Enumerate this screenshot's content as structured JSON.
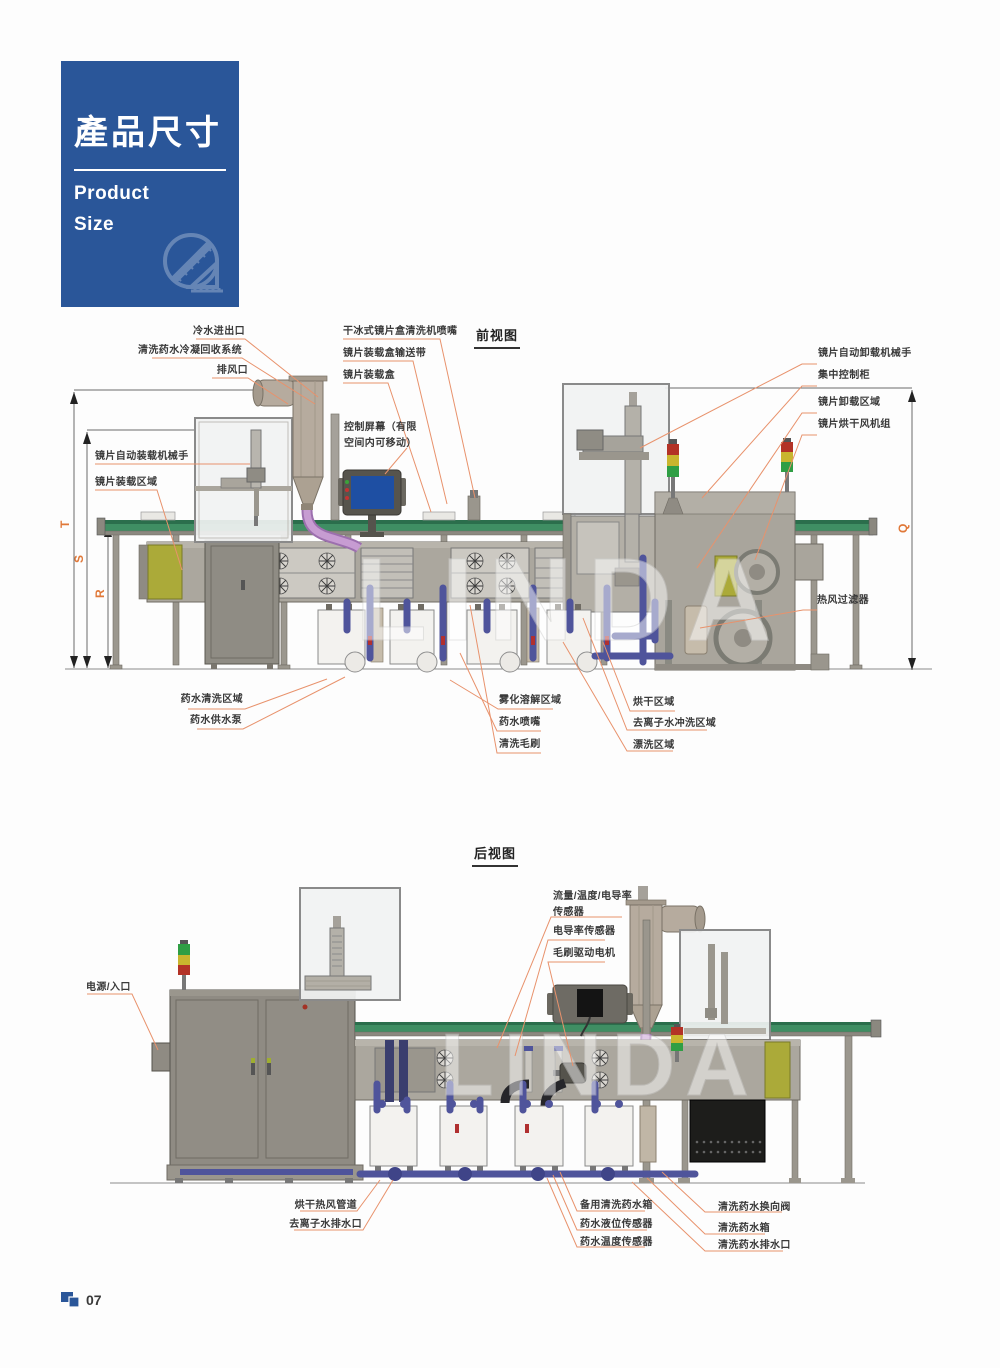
{
  "page": {
    "number": "07"
  },
  "brand_card": {
    "title": "產品尺寸",
    "subtitle_1": "Product",
    "subtitle_2": "Size",
    "bg_color": "#2a5699",
    "icon": "ruler-set-square-icon"
  },
  "front_view": {
    "title": "前视图",
    "watermark": "LINDA",
    "dimension_labels": {
      "t": "T",
      "s": "S",
      "r": "R",
      "q": "Q"
    },
    "labels": {
      "cold_water_inlet_outlet": "冷水进出口",
      "cleaning_fluid_condensate_recovery": "清洗药水冷凝回收系统",
      "exhaust_port": "排风口",
      "dry_ice_lens_box_cleaner_nozzle": "干冰式镜片盒清洗机喷嘴",
      "lens_box_conveyor_belt": "镜片装载盒输送带",
      "lens_loading_box": "镜片装载盒",
      "control_screen": "控制屏幕（有限\n空间内可移动）",
      "lens_auto_loading_robot": "镜片自动装载机械手",
      "lens_loading_area": "镜片装载区域",
      "lens_auto_unloading_robot": "镜片自动卸载机械手",
      "central_control_cabinet": "集中控制柜",
      "lens_unloading_area": "镜片卸载区域",
      "lens_drying_fan_unit": "镜片烘干风机组",
      "hot_air_filter": "热风过滤器",
      "fluid_cleaning_area": "药水清洗区域",
      "fluid_supply_pump": "药水供水泵",
      "atomization_dissolution_area": "雾化溶解区域",
      "fluid_nozzle": "药水喷嘴",
      "cleaning_brush": "清洗毛刷",
      "drying_area": "烘干区域",
      "di_water_rinse_area": "去离子水冲洗区域",
      "rinse_area": "漂洗区域"
    }
  },
  "rear_view": {
    "title": "后视图",
    "watermark": "LINDA",
    "labels": {
      "flow_temp_conductivity_sensor": "流量/温度/电导率\n传感器",
      "conductivity_sensor": "电导率传感器",
      "brush_drive_motor": "毛刷驱动电机",
      "power_inlet": "电源/入口",
      "drying_hot_air_duct": "烘干热风管道",
      "di_water_drain": "去离子水排水口",
      "backup_cleaning_fluid_tank": "备用清洗药水箱",
      "fluid_level_sensor": "药水液位传感器",
      "fluid_temp_sensor": "药水温度传感器",
      "cleaning_fluid_diverter_valve": "清洗药水换向阀",
      "cleaning_fluid_tank": "清洗药水箱",
      "cleaning_fluid_drain": "清洗药水排水口"
    }
  },
  "colors": {
    "accent_blue": "#2a5699",
    "callout_line": "#e8926c",
    "dimension_text": "#e07838",
    "conveyor_green": "#3f8e63",
    "machine_gray": "#aba79e"
  }
}
